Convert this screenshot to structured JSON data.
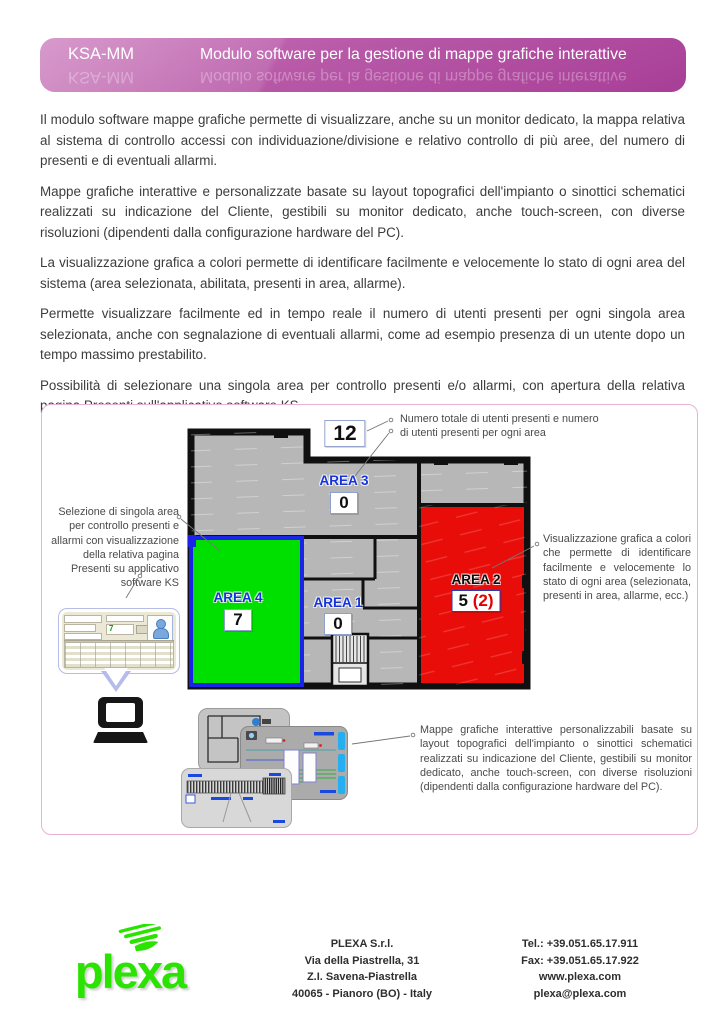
{
  "header": {
    "code": "KSA-MM",
    "title": "Modulo software per la gestione di mappe grafiche interattive"
  },
  "paragraphs": [
    "Il modulo software mappe grafiche permette di visualizzare, anche su un monitor dedicato, la mappa relativa al sistema di controllo accessi con individuazione/divisione e relativo controllo di più aree, del numero di presenti e di eventuali allarmi.",
    "Mappe grafiche interattive e personalizzate basate su layout topografici dell'impianto o sinottici schematici realizzati su indicazione del Cliente, gestibili su monitor dedicato, anche touch-screen, con diverse risoluzioni (dipendenti dalla configurazione hardware del PC).",
    "La visualizzazione grafica a colori permette di identificare facilmente e velocemente lo stato di ogni area del sistema (area selezionata, abilitata, presenti in area, allarme).",
    "Permette visualizzare facilmente ed in tempo reale il numero di utenti presenti per ogni singola area selezionata, anche con segnalazione di eventuali allarmi, come ad esempio presenza di un utente dopo un tempo massimo prestabilito.",
    "Possibilità di selezionare una singola area per controllo presenti e/o allarmi, con apertura della relativa pagina Presenti sull'applicativo software KS."
  ],
  "figure": {
    "annotation_top": "Numero totale di utenti presenti e numero di utenti presenti per ogni area",
    "annotation_left": "Selezione di singola area per controllo presenti e allarmi con visualizzazione della relativa pagina Presenti su applicativo software KS",
    "annotation_right": "Visualizzazione grafica a colori che permette di identificare facilmente e velocemente lo stato di ogni area (selezionata, presenti in area, allarme, ecc.)",
    "annotation_bottom": "Mappe grafiche interattive personalizzabili basate su layout topografici dell'impianto o sinottici schematici realizzati su indicazione del Cliente, gestibili su monitor dedicato, anche touch-screen, con diverse risoluzioni (dipendenti dalla configurazione hardware del PC).",
    "total_presences": "12",
    "areas": {
      "area1": {
        "label": "AREA 1",
        "count": "0"
      },
      "area2": {
        "label": "AREA 2",
        "count": "5",
        "alarm_count": "(2)"
      },
      "area3": {
        "label": "AREA 3",
        "count": "0"
      },
      "area4": {
        "label": "AREA 4",
        "count": "7"
      }
    },
    "ks_preview": {
      "count": "7"
    }
  },
  "colors": {
    "header_magenta": "#b14da0",
    "figure_border_pink": "#e7b2d7",
    "area_green": "#00e000",
    "area_red": "#e90d0a",
    "area_gray": "#b7b7b7",
    "area_label_blue": "#1532da",
    "alarm_red": "#e20000",
    "logo_green": "#2be300"
  },
  "footer": {
    "logo_text": "plexa",
    "address": [
      "PLEXA S.r.l.",
      "Via della Piastrella, 31",
      "Z.I. Savena-Piastrella",
      "40065 - Pianoro (BO) - Italy"
    ],
    "contacts": [
      "Tel.: +39.051.65.17.911",
      "Fax: +39.051.65.17.922",
      "www.plexa.com",
      "plexa@plexa.com"
    ]
  }
}
